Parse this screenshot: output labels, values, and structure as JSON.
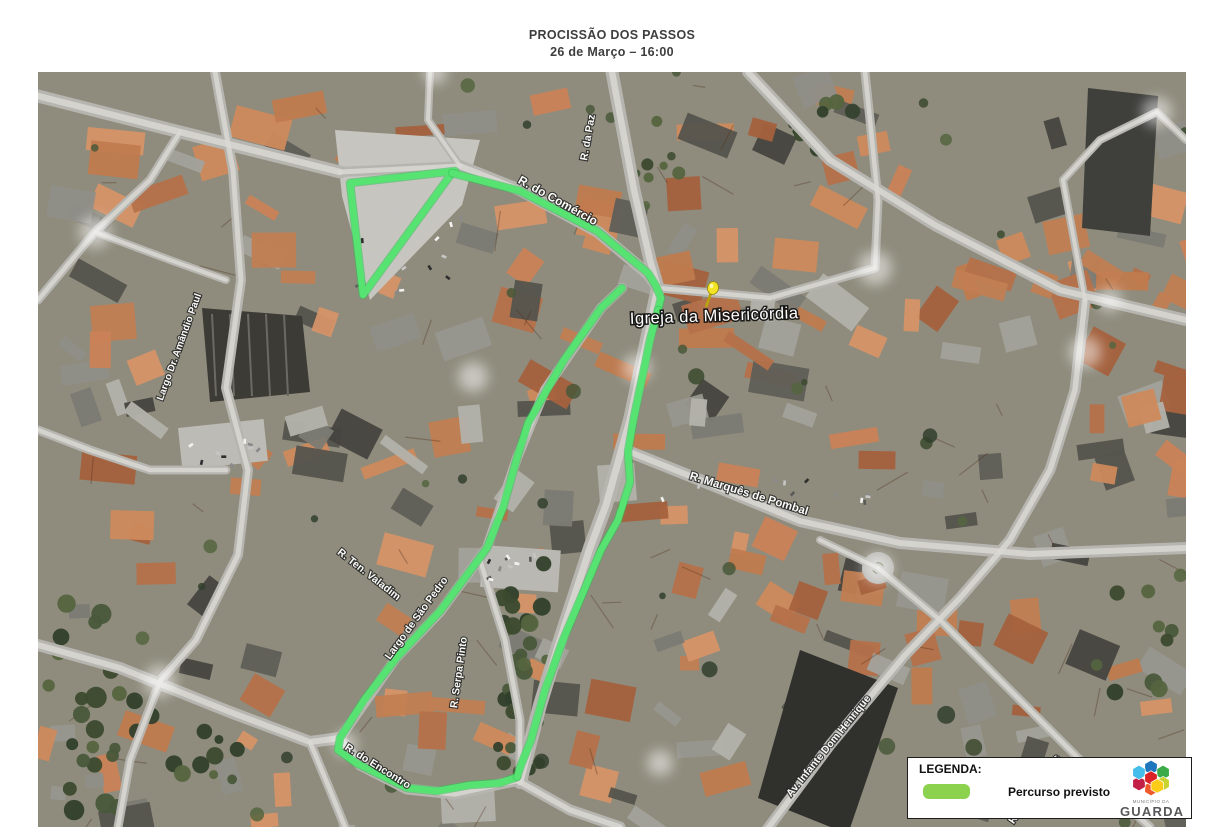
{
  "title": {
    "line1": "PROCISSÃO DOS PASSOS",
    "line2": "26 de Março – 16:00"
  },
  "map": {
    "poi_label": {
      "text": "Igreja da Misericórdia",
      "x": 630,
      "y": 324,
      "rot": -2,
      "size": 16.5
    },
    "marker": {
      "name": "yellow-pushpin",
      "x": 713,
      "y": 288,
      "head_color": "#F2E424",
      "stem_color": "#b9a50a"
    },
    "street_labels": [
      {
        "text": "R. do Comércio",
        "x": 556,
        "y": 204,
        "rot": 29,
        "size": 12
      },
      {
        "text": "R. da Paz",
        "x": 591,
        "y": 138,
        "rot": -80,
        "size": 10.5
      },
      {
        "text": "R. Marquês de Pombal",
        "x": 748,
        "y": 497,
        "rot": 17,
        "size": 11.5
      },
      {
        "text": "Largo Dr. Amândio Paul",
        "x": 182,
        "y": 348,
        "rot": -70,
        "size": 10
      },
      {
        "text": "R. Ten. Valadim",
        "x": 367,
        "y": 577,
        "rot": 38,
        "size": 10.5
      },
      {
        "text": "Largo de São Pedro",
        "x": 419,
        "y": 620,
        "rot": -54,
        "size": 10.5
      },
      {
        "text": "R. Serpa Pinto",
        "x": 462,
        "y": 673,
        "rot": -82,
        "size": 10.5
      },
      {
        "text": "R. do Encontro",
        "x": 376,
        "y": 769,
        "rot": 32,
        "size": 10.5
      },
      {
        "text": "Av. Infante Dom Henrique",
        "x": 831,
        "y": 748,
        "rot": -51,
        "size": 10.5
      },
      {
        "text": "R. João de Deus",
        "x": 1037,
        "y": 791,
        "rot": -55,
        "size": 10.5
      }
    ],
    "route": {
      "color": "#57E372",
      "width": 6.5,
      "paths": [
        [
          [
            455,
            171
          ],
          [
            350,
            183
          ],
          [
            363,
            295
          ],
          [
            452,
            173
          ]
        ],
        [
          [
            452,
            173
          ],
          [
            520,
            191
          ],
          [
            597,
            231
          ],
          [
            648,
            273
          ],
          [
            656,
            286
          ],
          [
            661,
            298
          ],
          [
            658,
            310
          ]
        ],
        [
          [
            622,
            288
          ],
          [
            601,
            308
          ],
          [
            564,
            360
          ],
          [
            528,
            423
          ],
          [
            517,
            458
          ],
          [
            503,
            508
          ],
          [
            487,
            548
          ],
          [
            441,
            610
          ],
          [
            397,
            657
          ],
          [
            364,
            700
          ],
          [
            340,
            738
          ],
          [
            338,
            750
          ],
          [
            356,
            763
          ],
          [
            407,
            788
          ],
          [
            437,
            791
          ],
          [
            470,
            785
          ],
          [
            500,
            783
          ],
          [
            517,
            777
          ]
        ],
        [
          [
            658,
            310
          ],
          [
            650,
            340
          ],
          [
            634,
            417
          ],
          [
            628,
            452
          ],
          [
            630,
            482
          ],
          [
            618,
            520
          ],
          [
            601,
            550
          ],
          [
            585,
            588
          ],
          [
            563,
            640
          ],
          [
            545,
            690
          ],
          [
            531,
            740
          ],
          [
            521,
            765
          ],
          [
            517,
            777
          ]
        ]
      ]
    }
  },
  "legend": {
    "heading": "LEGENDA:",
    "items": [
      {
        "label": "Percurso previsto",
        "swatch_color": "#8CD24F",
        "swatch_style": "background:#8CD24F"
      }
    ],
    "logo": {
      "small_text": "MUNICÍPIO DA",
      "large_text": "GUARDA",
      "cube_colors": [
        "#1F76BC",
        "#3BAA49",
        "#C9D330",
        "#FBCB18",
        "#F0592A",
        "#C22047",
        "#45BDEB",
        "#DB2128"
      ]
    }
  }
}
